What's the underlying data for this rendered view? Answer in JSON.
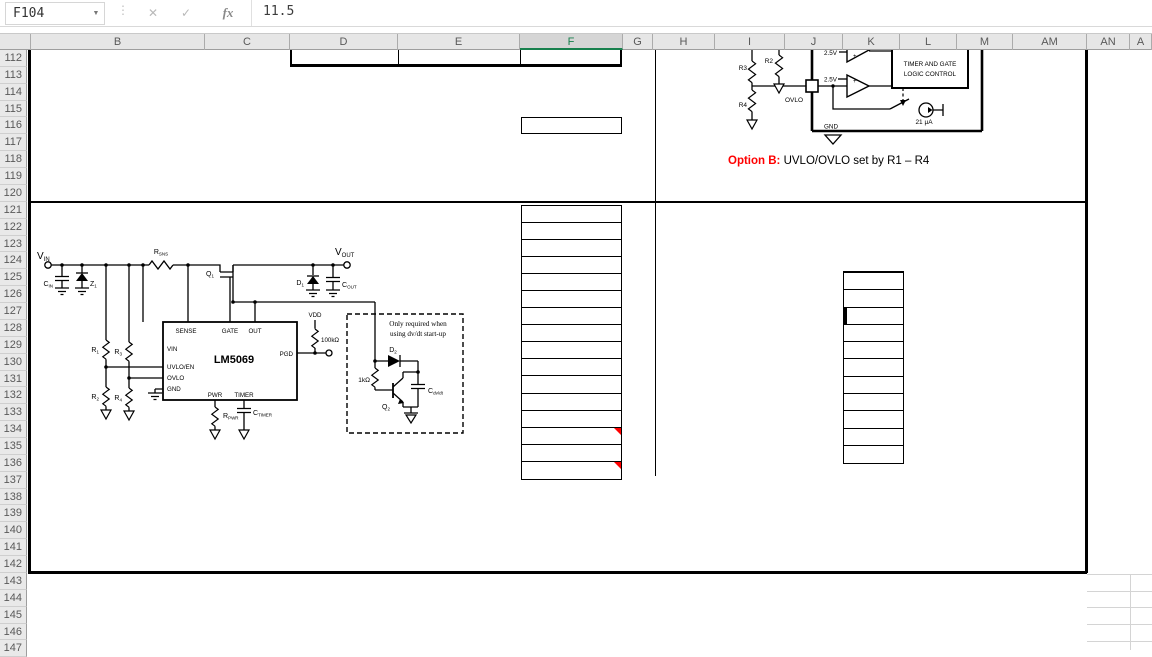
{
  "formula_bar": {
    "name_box": "F104",
    "formula": "11.5",
    "cancel_glyph": "✕",
    "confirm_glyph": "✓",
    "fx_glyph": "fx",
    "menu_dots": "⋮",
    "name_dropdown": "▼"
  },
  "grid": {
    "selected_column": "F",
    "columns": [
      "",
      "B",
      "C",
      "D",
      "E",
      "F",
      "G",
      "H",
      "I",
      "J",
      "K",
      "L",
      "M",
      "AM",
      "AN",
      "A"
    ],
    "first_row": 112,
    "last_row": 147
  },
  "tables": {
    "f_column": {
      "rows": 16,
      "comment_rows": [
        14,
        16
      ]
    },
    "k_column": {
      "rows": 11,
      "thick_left_row": 3
    }
  },
  "annotations": {
    "option_b_label": "Option B:",
    "option_b_text": " UVLO/OVLO set by R1 – R4"
  },
  "circuit_top": {
    "r2": "R2",
    "r3": "R3",
    "r4": "R4",
    "ovlo": "OVLO",
    "gnd": "GND",
    "vref_upper": "2.5V",
    "vref_lower": "2.5V",
    "plus_upper": "+",
    "plus_lower": "+",
    "current_source": "21 μA",
    "logic_box_line1": "TIMER AND GATE",
    "logic_box_line2": "LOGIC CONTROL"
  },
  "circuit_main": {
    "vin": {
      "main": "V",
      "sub": "IN"
    },
    "vout": {
      "main": "V",
      "sub": "OUT"
    },
    "rsns": {
      "main": "R",
      "sub": "SNS"
    },
    "q1": {
      "main": "Q",
      "sub": "1"
    },
    "cin": {
      "main": "C",
      "sub": "IN"
    },
    "z1": {
      "main": "Z",
      "sub": "1"
    },
    "r1": {
      "main": "R",
      "sub": "1"
    },
    "r2": {
      "main": "R",
      "sub": "2"
    },
    "r3": {
      "main": "R",
      "sub": "3"
    },
    "r4": {
      "main": "R",
      "sub": "4"
    },
    "d1": {
      "main": "D",
      "sub": "1"
    },
    "cout": {
      "main": "C",
      "sub": "OUT"
    },
    "ic_name": "LM5069",
    "pins": {
      "sense": "SENSE",
      "gate": "GATE",
      "out": "OUT",
      "vin": "VIN",
      "uvlo_en": "UVLO/EN",
      "ovlo": "OVLO",
      "gnd": "GND",
      "pwr": "PWR",
      "timer": "TIMER",
      "pgd": "PGD"
    },
    "vdd": "VDD",
    "pullup": "100kΩ",
    "rpwr": {
      "main": "R",
      "sub": "PWR"
    },
    "ctimer": {
      "main": "C",
      "sub": "TIMER"
    },
    "note_line1": "Only required when",
    "note_line2": "using dv/dt start-up",
    "d2": {
      "main": "D",
      "sub": "2"
    },
    "q2": {
      "main": "Q",
      "sub": "2"
    },
    "r1k": "1kΩ",
    "cdvdt": {
      "main": "C",
      "sub": "dv/dt"
    }
  },
  "colors": {
    "selection_green": "#17804d",
    "comment_red": "#ff0000",
    "label_red": "#ff0000"
  }
}
